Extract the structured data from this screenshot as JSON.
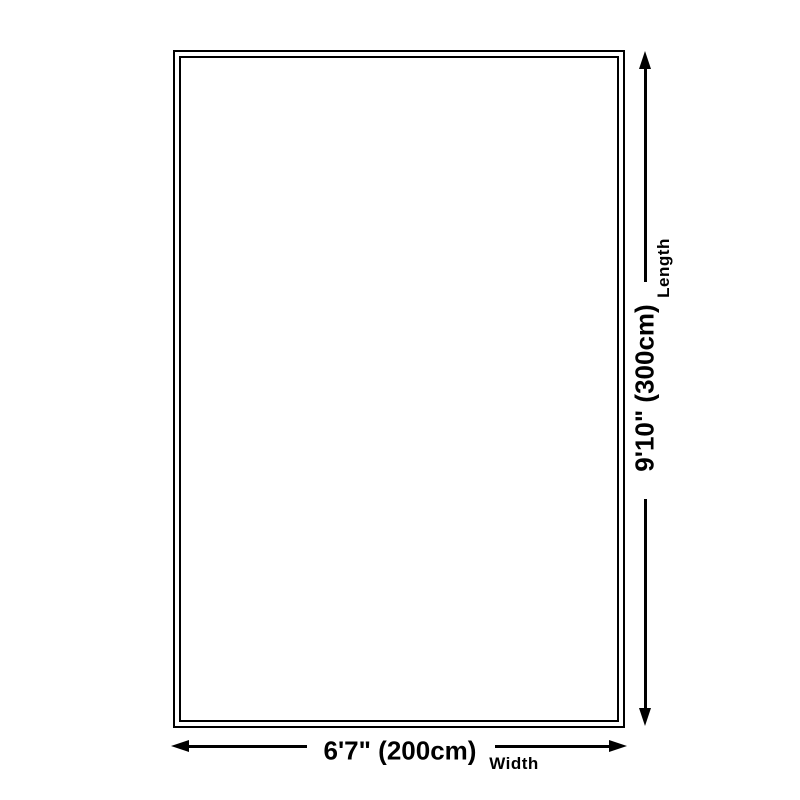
{
  "page": {
    "background_color": "#ffffff",
    "line_color": "#000000"
  },
  "diagram": {
    "rug": {
      "fill_color": "#ffffff",
      "border_color": "#000000",
      "border_style": "double"
    },
    "length": {
      "value": "9'10\" (300cm)",
      "label": "Length"
    },
    "width": {
      "value": "6'7\" (200cm)",
      "label": "Width"
    }
  }
}
